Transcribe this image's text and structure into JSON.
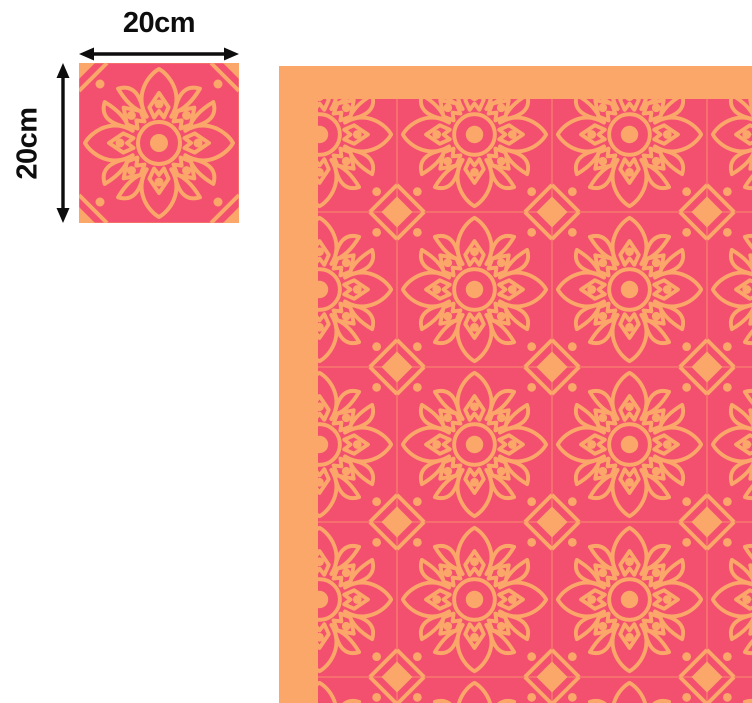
{
  "page": {
    "background": "#ffffff"
  },
  "dimensions": {
    "width_label": "20cm",
    "height_label": "20cm"
  },
  "colors": {
    "tile_background": "#F2506E",
    "pattern_motif": "#FBA76A",
    "floor_border": "#FBA76A",
    "annotation": "#0D0D0D"
  },
  "motif_name": "mandala-flower-tile",
  "icons": {
    "width_arrow": "double-headed-horizontal-arrow",
    "height_arrow": "double-headed-vertical-arrow"
  }
}
